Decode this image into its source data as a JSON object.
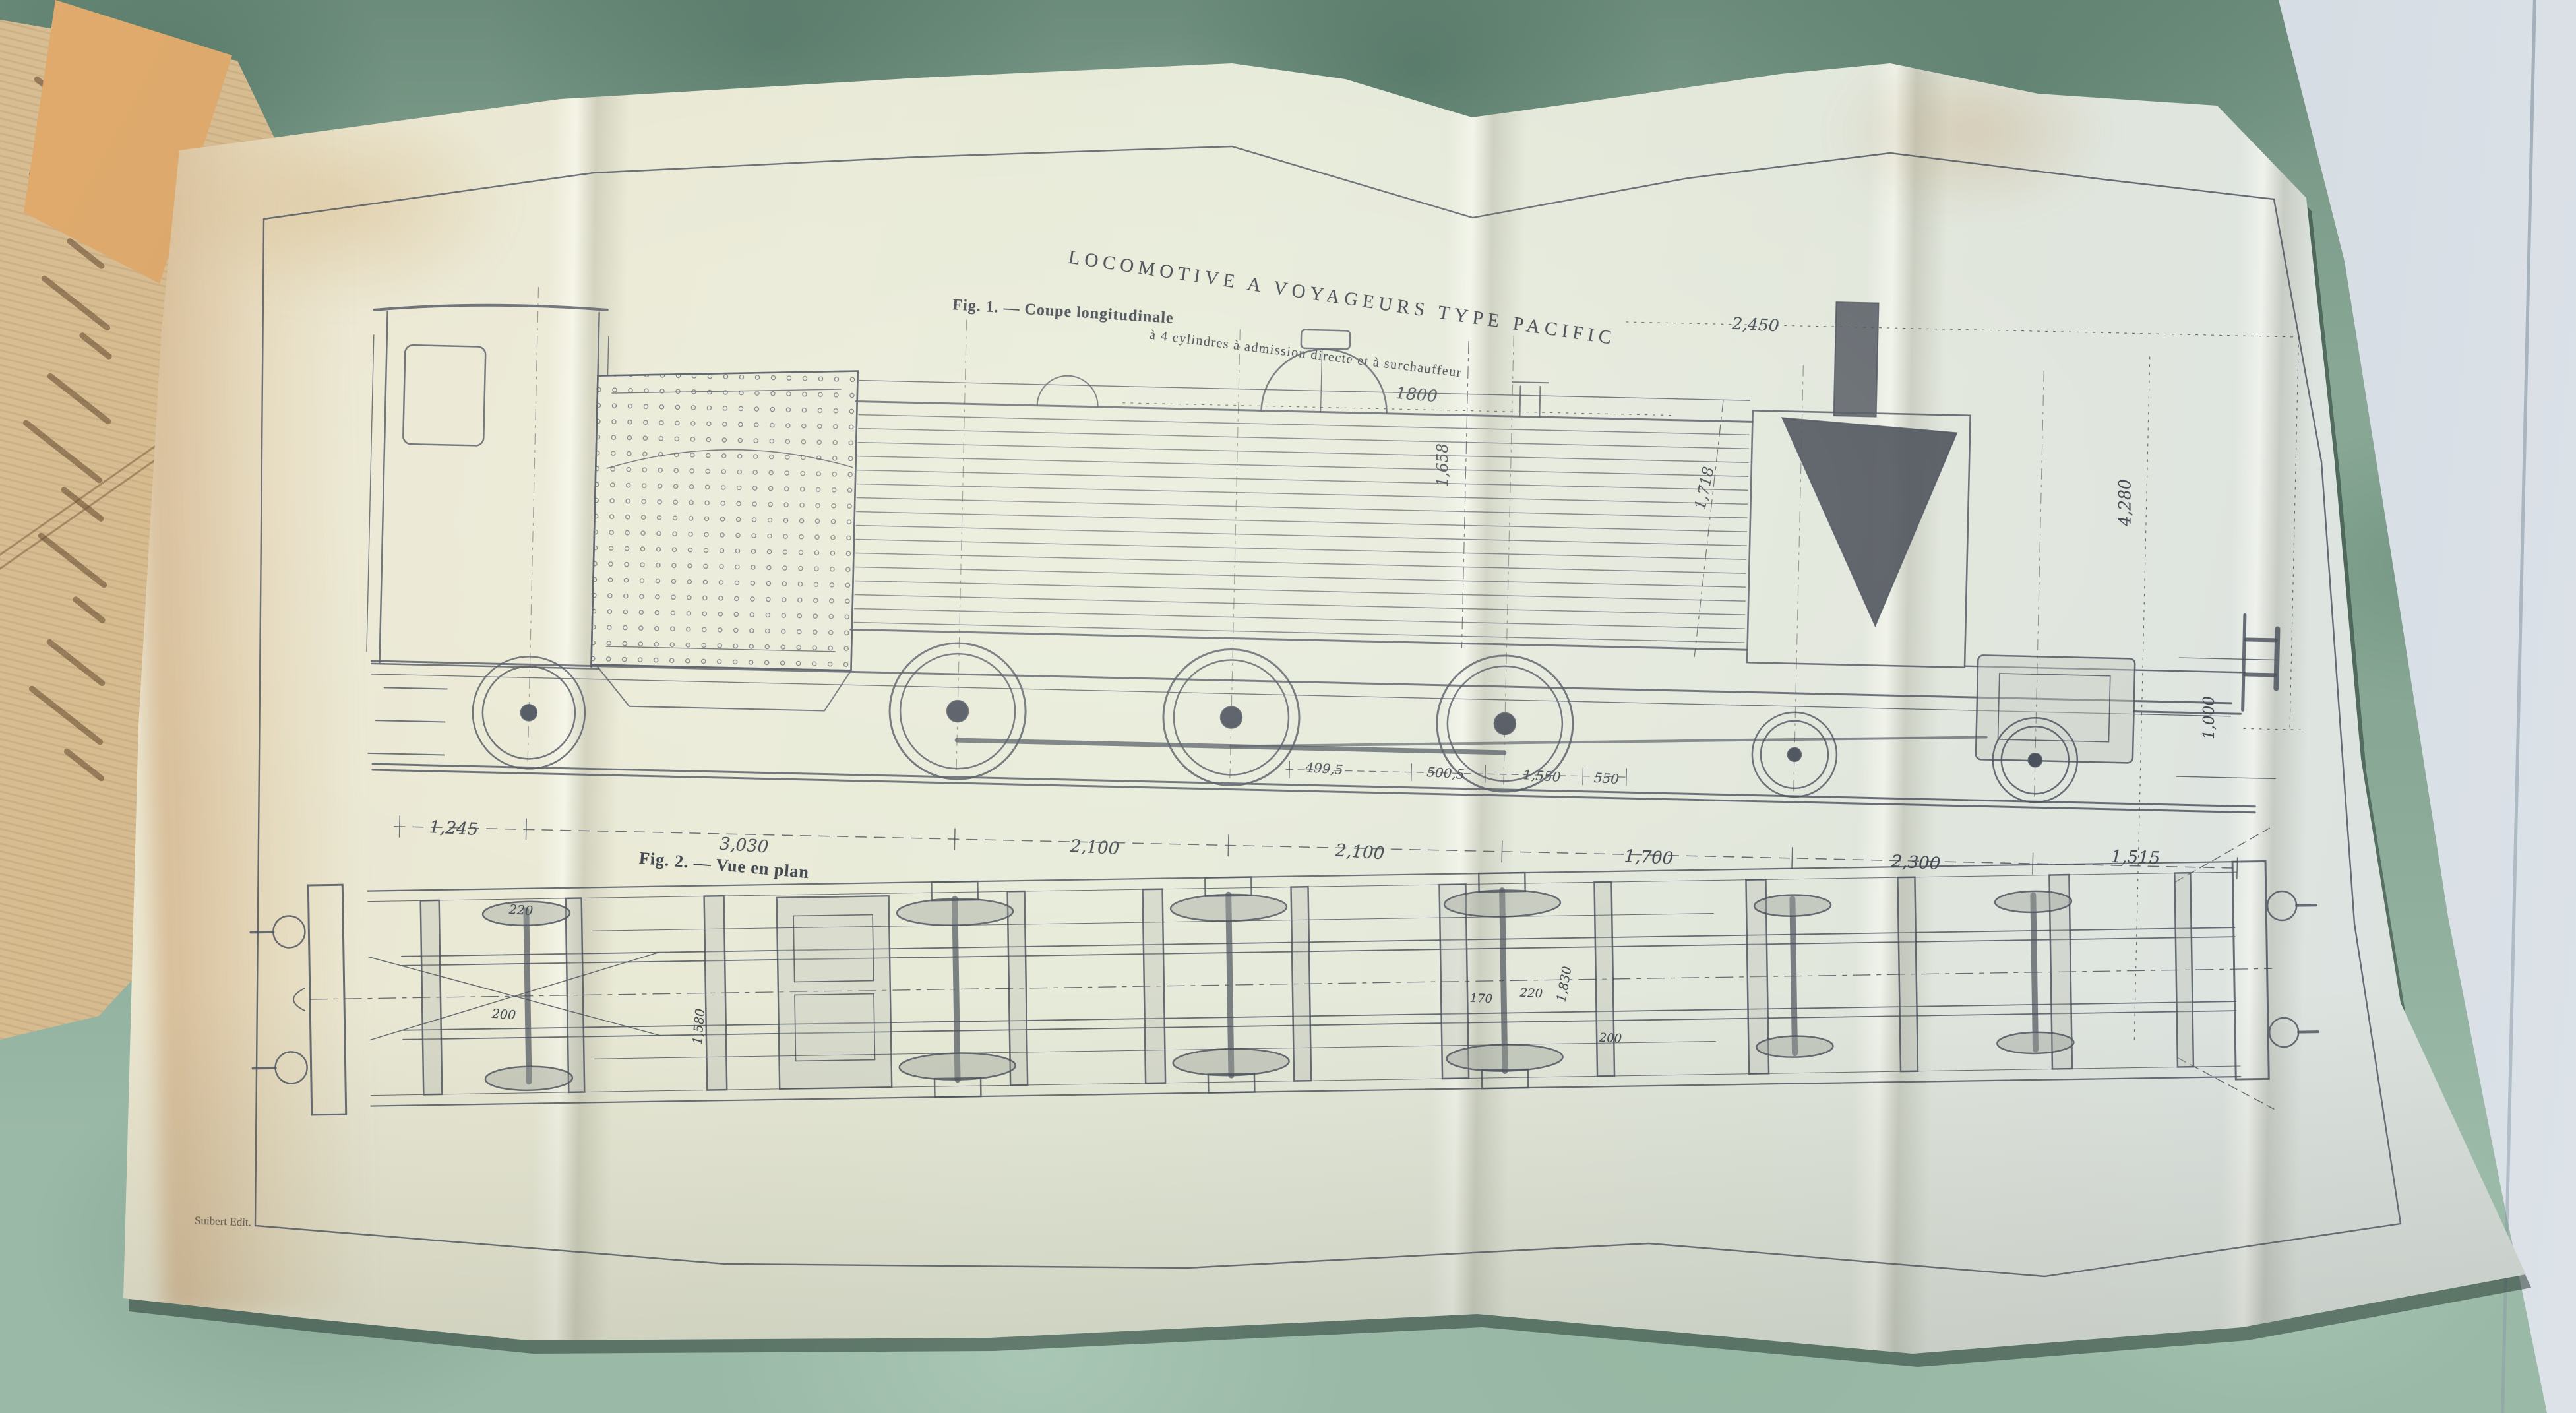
{
  "plate": {
    "title": "LOCOMOTIVE A VOYAGEURS TYPE PACIFIC",
    "subtitle": "à 4 cylindres à admission directe et à surchauffeur",
    "credit": "Suibert Edit.",
    "fig1": {
      "caption": "Fig. 1. — Coupe longitudinale",
      "top_dimensions": [
        "1800",
        "2,450"
      ],
      "bottom_dimensions": [
        "1,245",
        "3,030",
        "2,100",
        "2,100",
        "1,700",
        "2,300",
        "1,515"
      ],
      "detail_dimensions": [
        "499,5",
        "500,5",
        "1,550",
        "550"
      ],
      "vertical_dimensions": [
        "1,658",
        "1,718",
        "4,280",
        "1,000"
      ]
    },
    "fig2": {
      "caption": "Fig. 2. — Vue en plan",
      "detail_dimensions": [
        "220",
        "200",
        "1,580",
        "170",
        "220",
        "1,830",
        "200"
      ]
    }
  },
  "colors": {
    "fabric_green": "#8fb09e",
    "wall_gray_blue": "#c6d0d8",
    "paper_cream": "#e9e9d7",
    "book_page_tan": "#d3b78c",
    "ink": "#474d56",
    "stain_orange": "#cc9356"
  }
}
